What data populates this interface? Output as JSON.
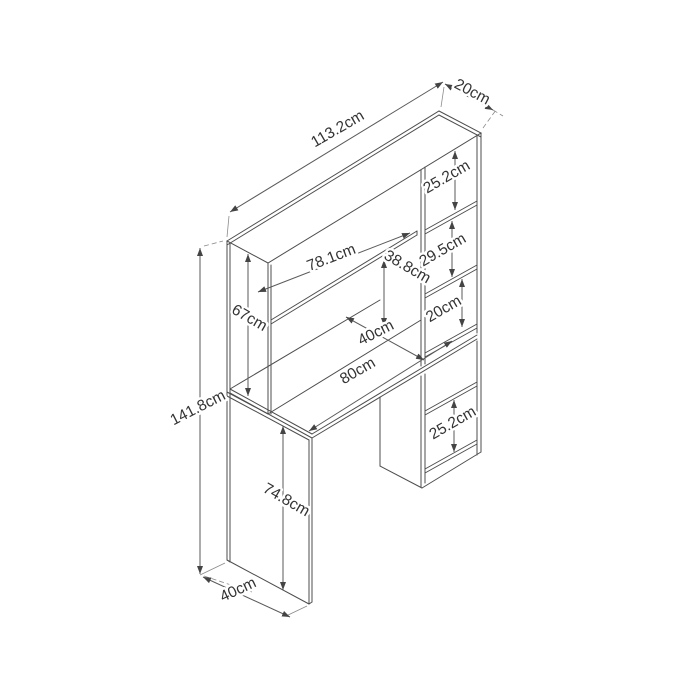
{
  "drawing": {
    "type": "furniture-dimension-diagram",
    "subject": "desk-with-hutch-and-bookshelf",
    "unit": "cm",
    "line_color": "#4d4d4d",
    "text_color": "#333333",
    "background_color": "#ffffff"
  },
  "dims": {
    "total_width": {
      "label": "113.2cm",
      "value": 113.2
    },
    "top_depth": {
      "label": "20cm",
      "value": 20
    },
    "compartment_top": {
      "label": "25.2cm",
      "value": 25.2
    },
    "shelf_width": {
      "label": "78.1cm",
      "value": 78.1
    },
    "hutch_clearance": {
      "label": "38.8cm",
      "value": 38.8
    },
    "compartment_mid": {
      "label": "29.5cm",
      "value": 29.5
    },
    "compartment_small": {
      "label": "20cm",
      "value": 20
    },
    "hutch_height": {
      "label": "67cm",
      "value": 67
    },
    "desk_depth": {
      "label": "40cm",
      "value": 40
    },
    "desk_width": {
      "label": "80cm",
      "value": 80
    },
    "total_height": {
      "label": "141.8cm",
      "value": 141.8
    },
    "leg_height": {
      "label": "74.8cm",
      "value": 74.8
    },
    "compartment_bottom": {
      "label": "25.2cm",
      "value": 25.2
    },
    "base_depth": {
      "label": "40cm",
      "value": 40
    }
  }
}
